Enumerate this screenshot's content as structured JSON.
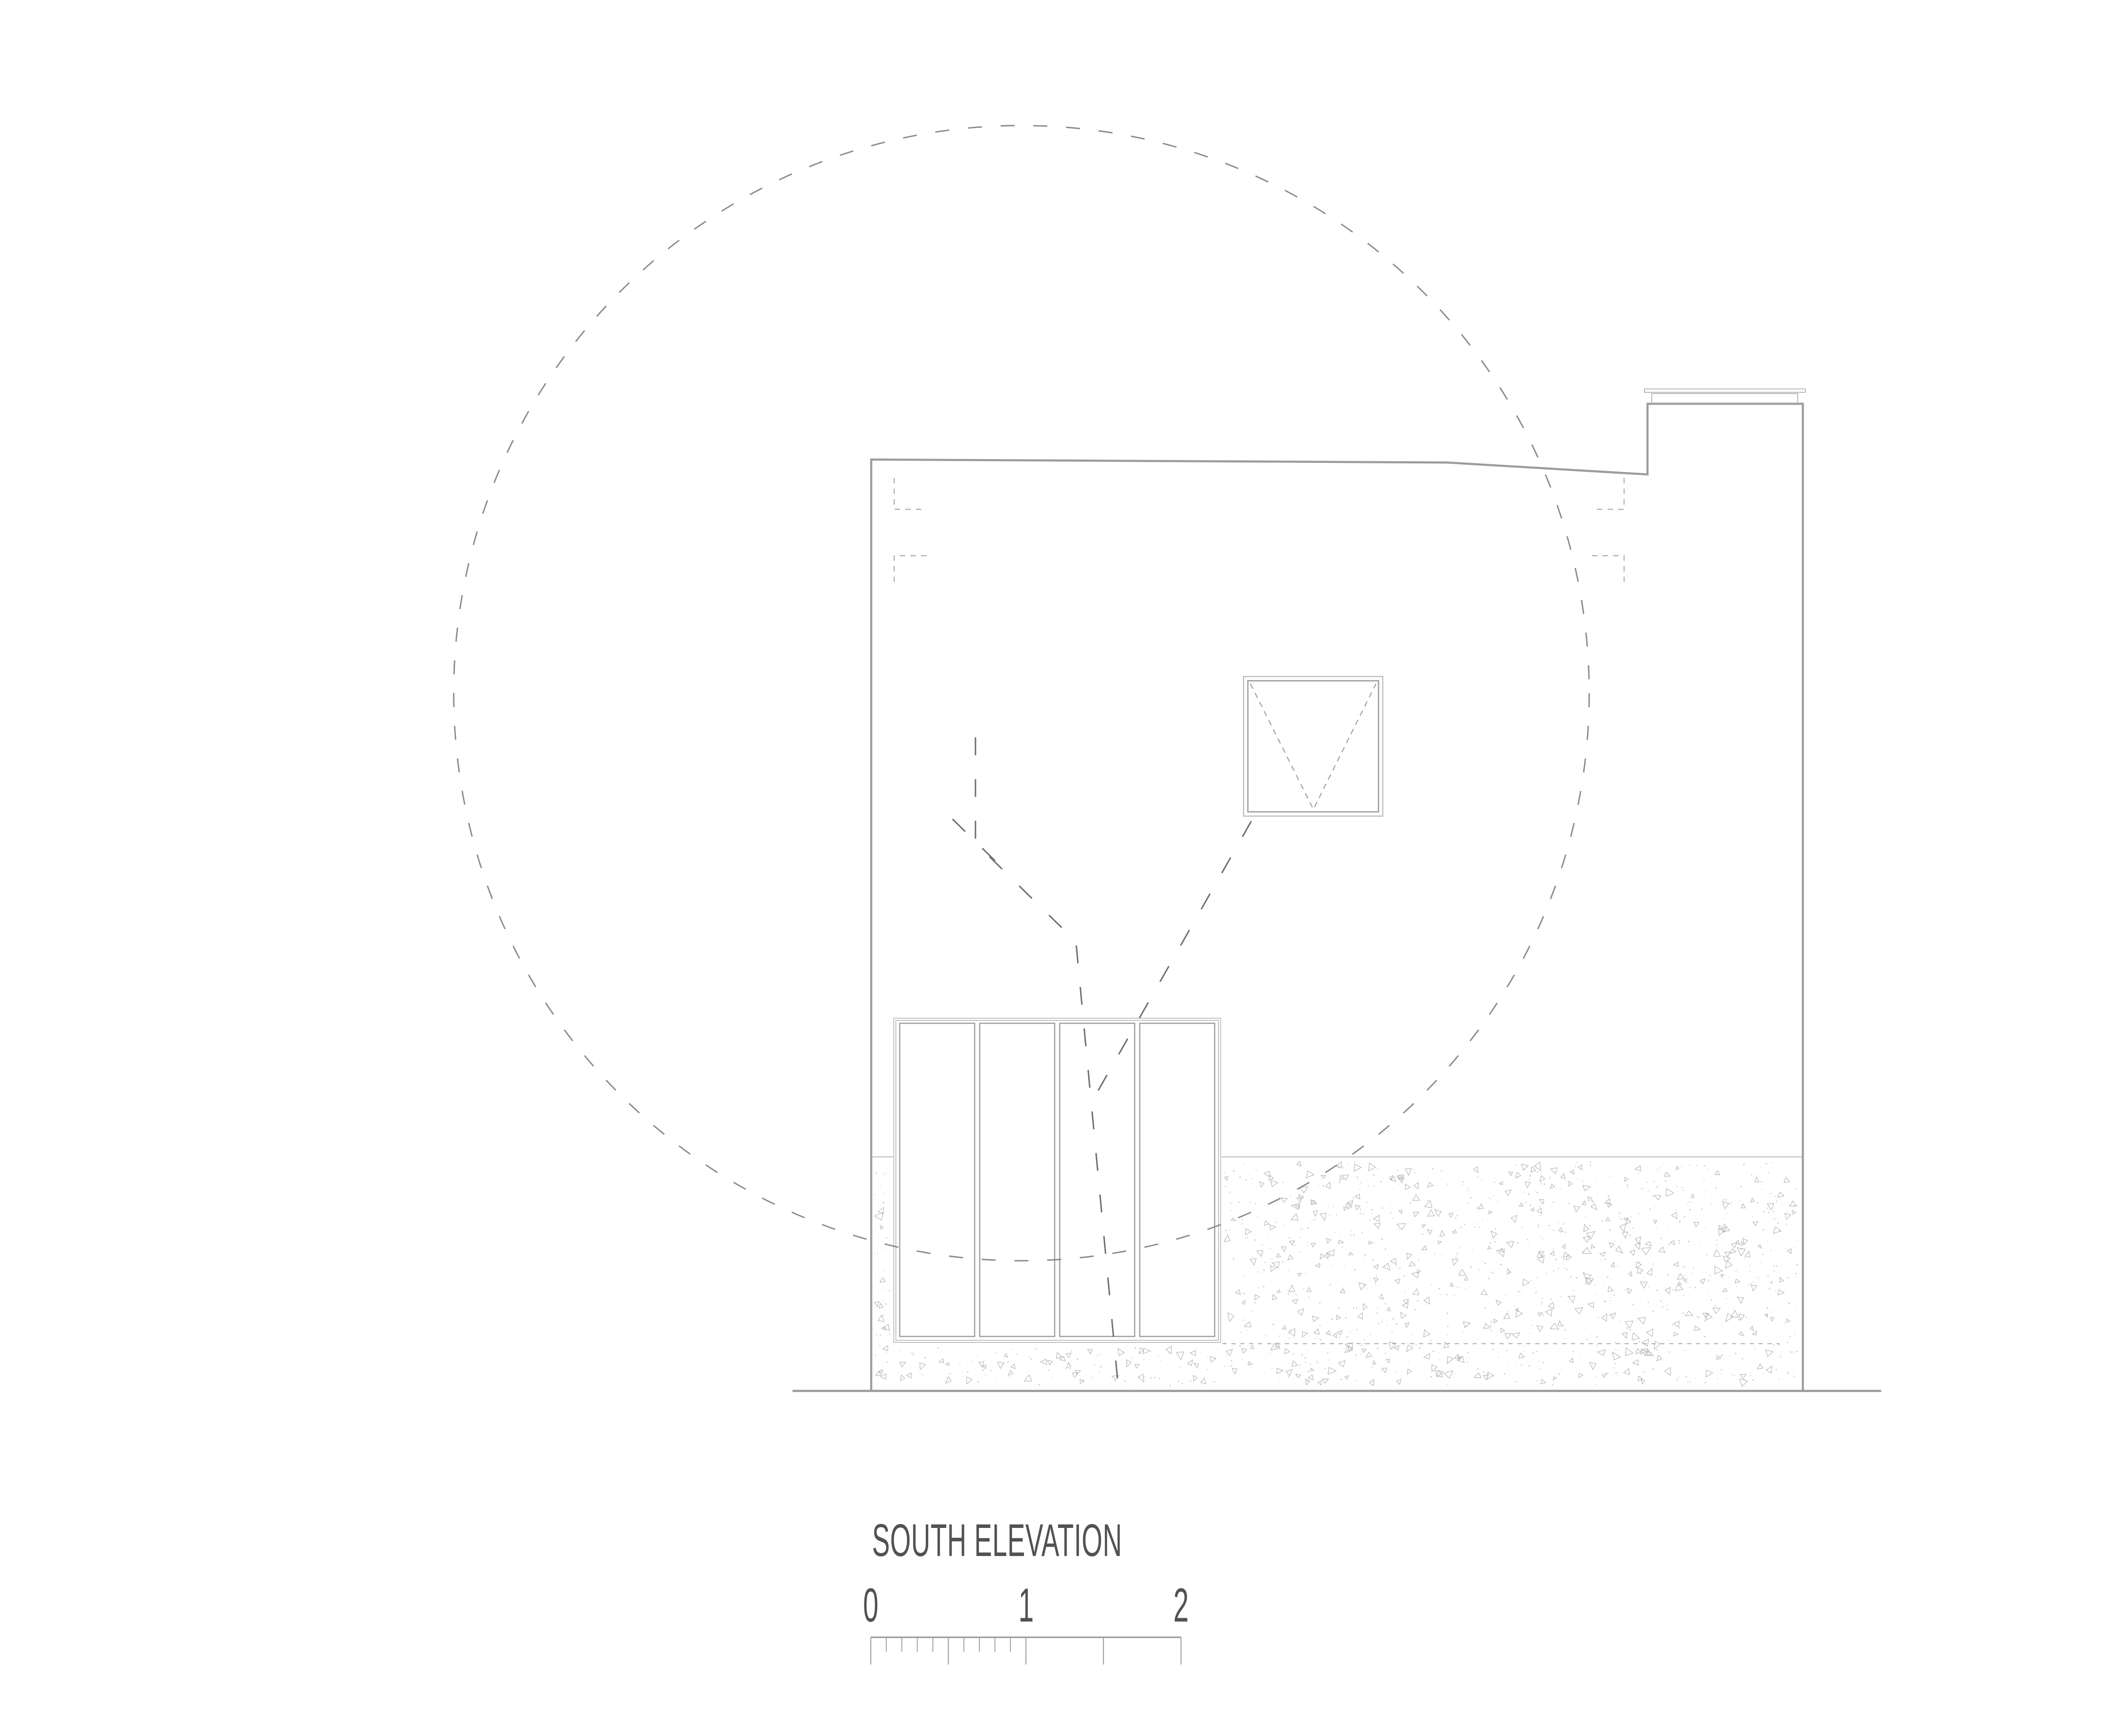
{
  "title": {
    "label": "SOUTH ELEVATION"
  },
  "scale_bar": {
    "labels": [
      "0",
      "1",
      "2"
    ]
  },
  "colors": {
    "wall_line": "#9c9c9c",
    "ground_line": "#9a9a9a",
    "detail_line": "#b4b4b4",
    "frame_light": "#b6b6b6",
    "panel_line": "#9e9e9e",
    "window_line": "#9d9d9d",
    "hidden_dash": "#ababab",
    "plinth_dash": "#aaaaaa",
    "tree_circle_dash": "#8a8a8a",
    "tree_trunk_dash": "#6f6f6f",
    "stipple": "#b0b0b0",
    "stipple_dot": "#c6c6c6",
    "scale_line": "#9a9a9a",
    "text": "#525252"
  }
}
